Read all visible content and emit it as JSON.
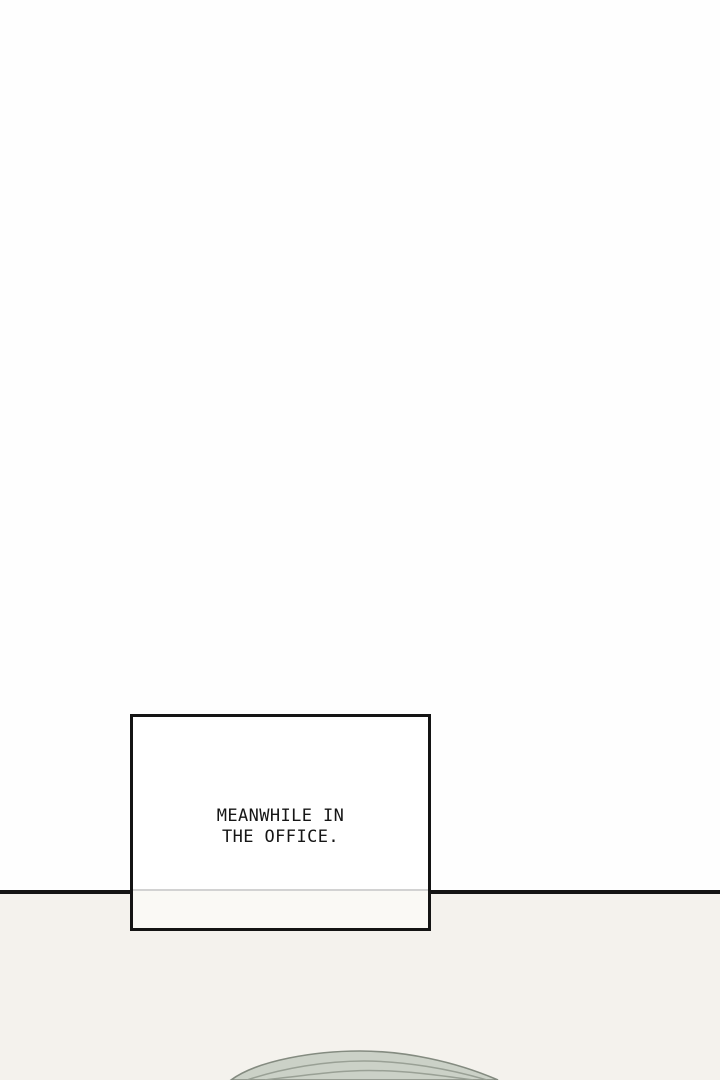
{
  "caption": {
    "line1": "MEANWHILE IN",
    "line2": "THE OFFICE."
  },
  "colors": {
    "page-bg": "#fefefe",
    "lower-bg": "#f4f2ed",
    "divider": "#141414",
    "caption-border": "#141414",
    "caption-lower-fill": "#faf9f5",
    "caption-inner-line": "#d2d2d2",
    "text": "#161616",
    "dome-fill": "#cbd1c7",
    "dome-line": "#99a095",
    "dome-outline": "#848b80"
  }
}
